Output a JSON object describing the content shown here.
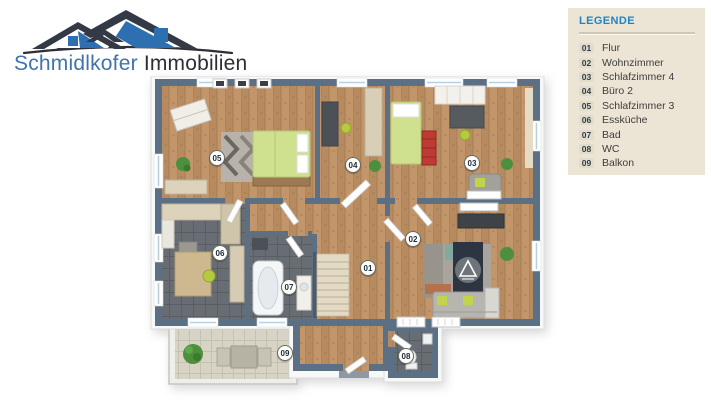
{
  "brand": {
    "name_primary": "Schmidlkofer",
    "name_secondary": "Immobilien"
  },
  "legend": {
    "title": "LEGENDE",
    "items": [
      {
        "num": "01",
        "label": "Flur"
      },
      {
        "num": "02",
        "label": "Wohnzimmer"
      },
      {
        "num": "03",
        "label": "Schlafzimmer 4"
      },
      {
        "num": "04",
        "label": "Büro 2"
      },
      {
        "num": "05",
        "label": "Schlafzimmer 3"
      },
      {
        "num": "06",
        "label": "Essküche"
      },
      {
        "num": "07",
        "label": "Bad"
      },
      {
        "num": "08",
        "label": "WC"
      },
      {
        "num": "09",
        "label": "Balkon"
      }
    ]
  },
  "colors": {
    "wall": "#5b7084",
    "wood": "#c2966a",
    "tile_dark": "#676d72",
    "panel_bg": "#ece5d5",
    "legend_title": "#1b86c7",
    "brand_blue": "#4272ab",
    "brand_dark": "#2e2e35",
    "bed_green": "#cfe08f",
    "accent_lime": "#b5cb3f"
  }
}
